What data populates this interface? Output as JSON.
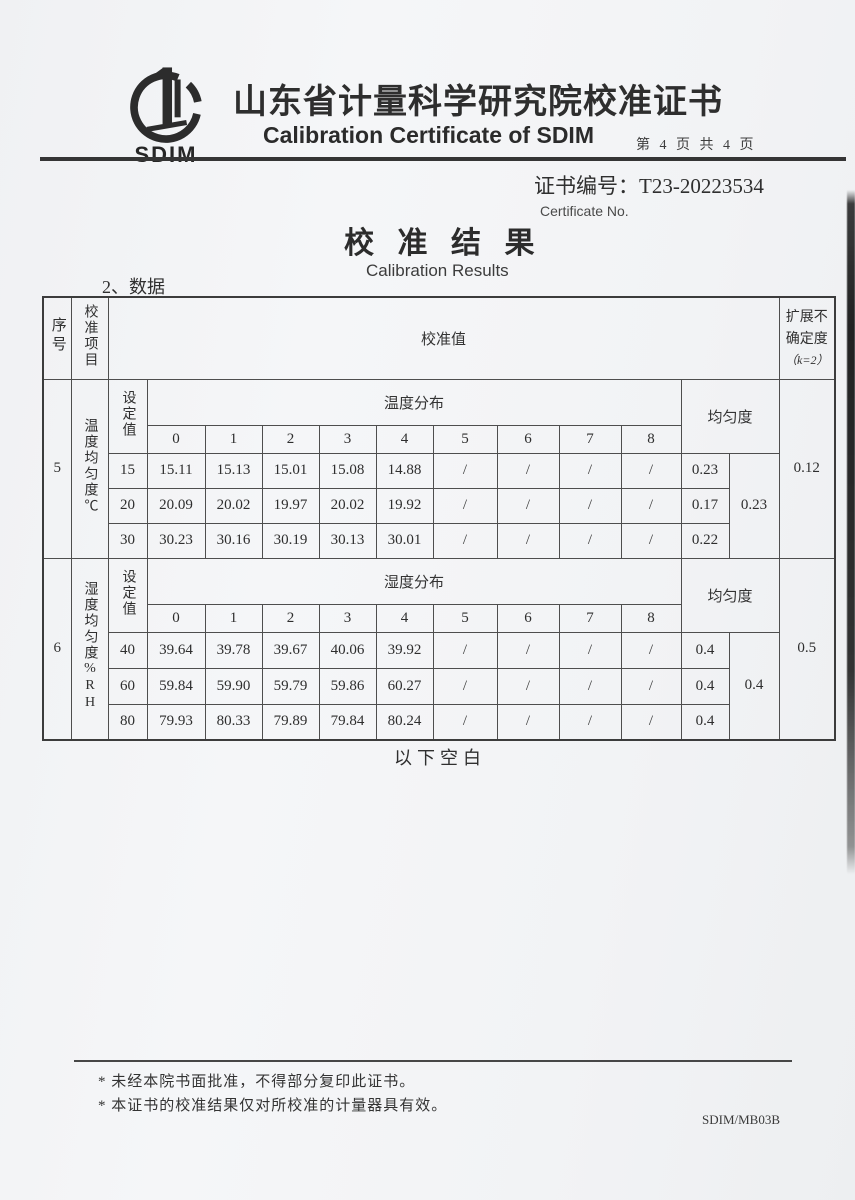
{
  "header": {
    "logo_text": "SDIM",
    "title_cn": "山东省计量科学研究院校准证书",
    "title_en": "Calibration Certificate of SDIM",
    "page_info": "第 4 页 共 4 页"
  },
  "certificate": {
    "number_label": "证书编号：",
    "number": "T23-20223534",
    "number_caption": "Certificate No."
  },
  "section": {
    "title_cn": "校 准 结 果",
    "title_en": "Calibration Results",
    "data_label": "2、数据"
  },
  "table": {
    "col_no": "序号",
    "col_item": "校准项目",
    "col_value": "校准值",
    "col_uncertainty": "扩展不确定度",
    "col_uncertainty_k": "（k=2）",
    "col_setpoint": "设定值",
    "col_uniformity": "均匀度",
    "positions": [
      "0",
      "1",
      "2",
      "3",
      "4",
      "5",
      "6",
      "7",
      "8"
    ],
    "sections": [
      {
        "no": "5",
        "item": "温度均匀度℃",
        "dist": "温度分布",
        "rows": [
          {
            "set": "15",
            "vals": [
              "15.11",
              "15.13",
              "15.01",
              "15.08",
              "14.88",
              "/",
              "/",
              "/",
              "/"
            ],
            "uni": "0.23"
          },
          {
            "set": "20",
            "vals": [
              "20.09",
              "20.02",
              "19.97",
              "20.02",
              "19.92",
              "/",
              "/",
              "/",
              "/"
            ],
            "uni": "0.17"
          },
          {
            "set": "30",
            "vals": [
              "30.23",
              "30.16",
              "30.19",
              "30.13",
              "30.01",
              "/",
              "/",
              "/",
              "/"
            ],
            "uni": "0.22"
          }
        ],
        "uni_max": "0.23",
        "uncertainty": "0.12"
      },
      {
        "no": "6",
        "item": "湿度均匀度%RH",
        "dist": "湿度分布",
        "rows": [
          {
            "set": "40",
            "vals": [
              "39.64",
              "39.78",
              "39.67",
              "40.06",
              "39.92",
              "/",
              "/",
              "/",
              "/"
            ],
            "uni": "0.4"
          },
          {
            "set": "60",
            "vals": [
              "59.84",
              "59.90",
              "59.79",
              "59.86",
              "60.27",
              "/",
              "/",
              "/",
              "/"
            ],
            "uni": "0.4"
          },
          {
            "set": "80",
            "vals": [
              "79.93",
              "80.33",
              "79.89",
              "79.84",
              "80.24",
              "/",
              "/",
              "/",
              "/"
            ],
            "uni": "0.4"
          }
        ],
        "uni_max": "0.4",
        "uncertainty": "0.5"
      }
    ],
    "below_blank": "以下空白"
  },
  "footer": {
    "note_1": "* 未经本院书面批准，不得部分复印此证书。",
    "note_2": "* 本证书的校准结果仅对所校准的计量器具有效。",
    "form_code": "SDIM/MB03B"
  }
}
